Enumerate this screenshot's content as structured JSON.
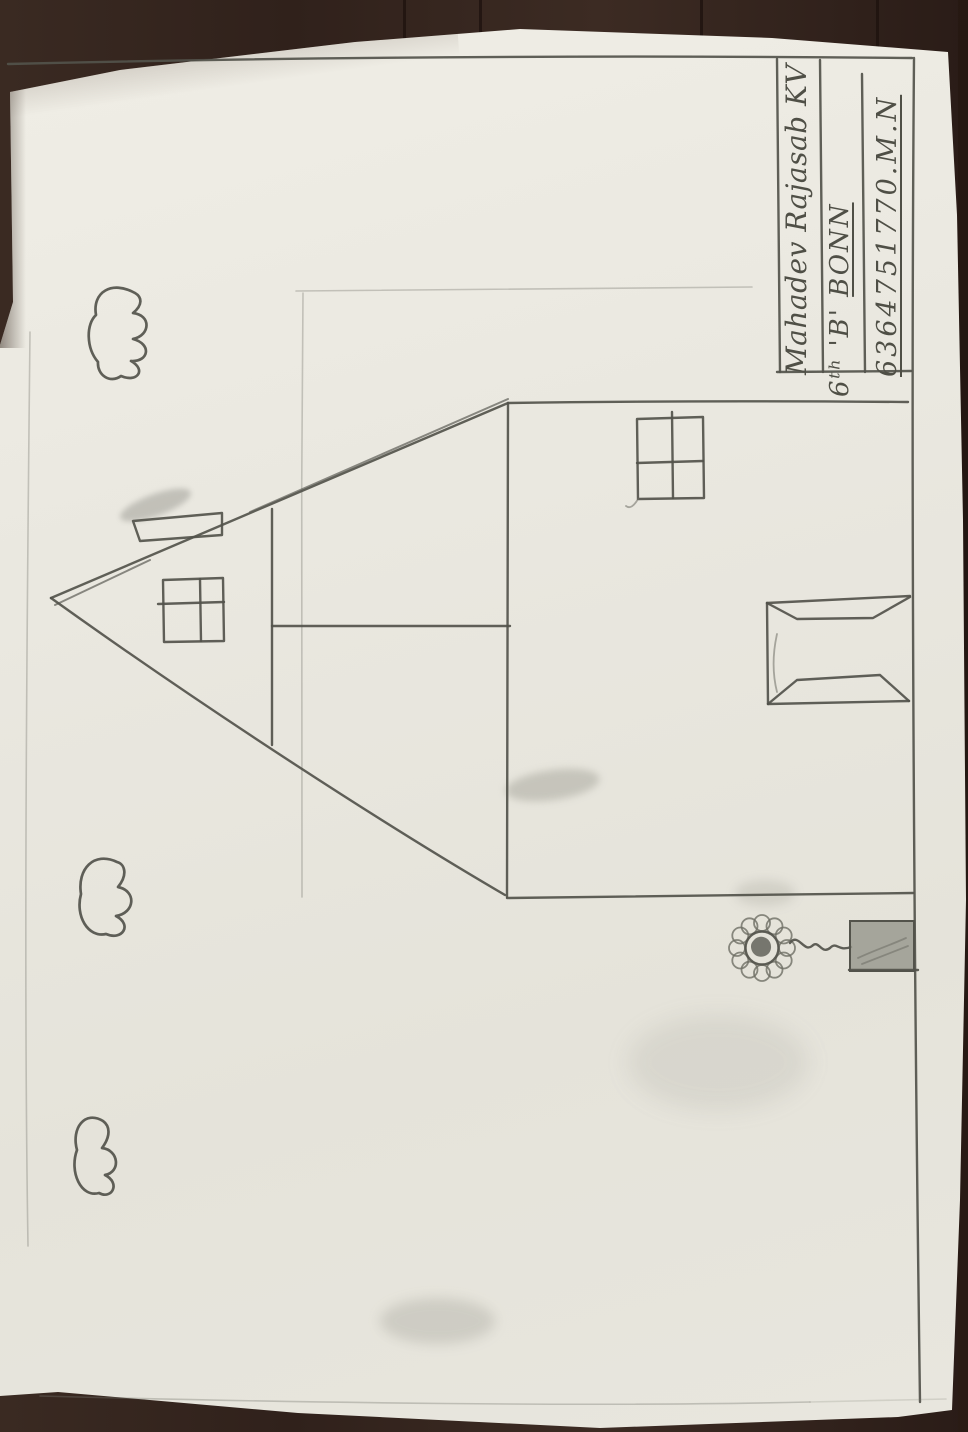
{
  "name_box": {
    "student_name": "Mahadev Rajasab KV",
    "class_label": "6ᵗʰ 'B' ",
    "school": "BONN",
    "phone": "6364751770.M.N"
  },
  "drawing_elements": {
    "house": "house outline with pitched roof",
    "roof": "triangular roof",
    "chimney": "chimney on roof slope",
    "gable_window": "four-pane gable window",
    "wall_window": "four-pane wall window",
    "door": "door drawn in perspective",
    "flower": "sunflower on wavy stem",
    "flower_pot": "shaded flower pot",
    "clouds": "three scalloped clouds"
  },
  "colors": {
    "paper": "#e9e7df",
    "table_wood": "#38271f",
    "pencil": "#53534b"
  }
}
